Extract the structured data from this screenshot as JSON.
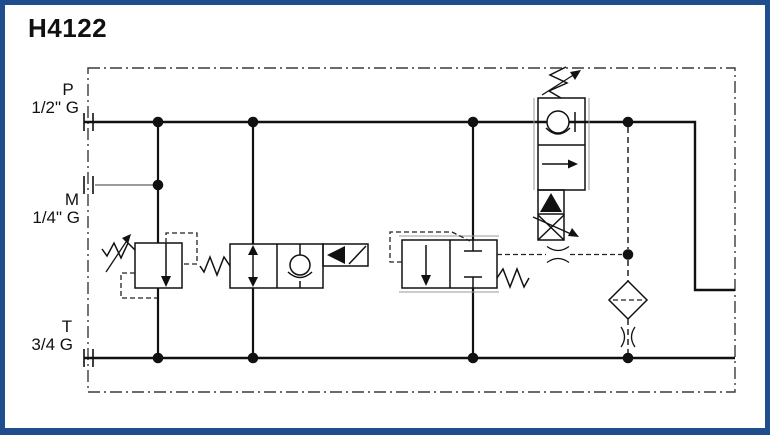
{
  "title": "H4122",
  "colors": {
    "frame": "#1f4e8c",
    "line": "#111111",
    "secondary_line": "#7a7a7a",
    "background": "#ffffff"
  },
  "ports": {
    "p": {
      "label": "P",
      "size": "1/2\" G"
    },
    "m": {
      "label": "M",
      "size": "1/4\" G"
    },
    "t": {
      "label": "T",
      "size": "3/4 G"
    }
  },
  "symbols": {
    "relief_valve": "adjustable-pressure-relief-valve",
    "solenoid_valve": "solenoid-poppet-valve-with-check",
    "pilot_valve": "pilot-operated-2-2-valve",
    "flow_compensator": "pressure-compensated-flow-control-with-check",
    "filter": "pilot-filter",
    "orifice": "fixed-orifice",
    "boundary": "manifold-envelope"
  }
}
